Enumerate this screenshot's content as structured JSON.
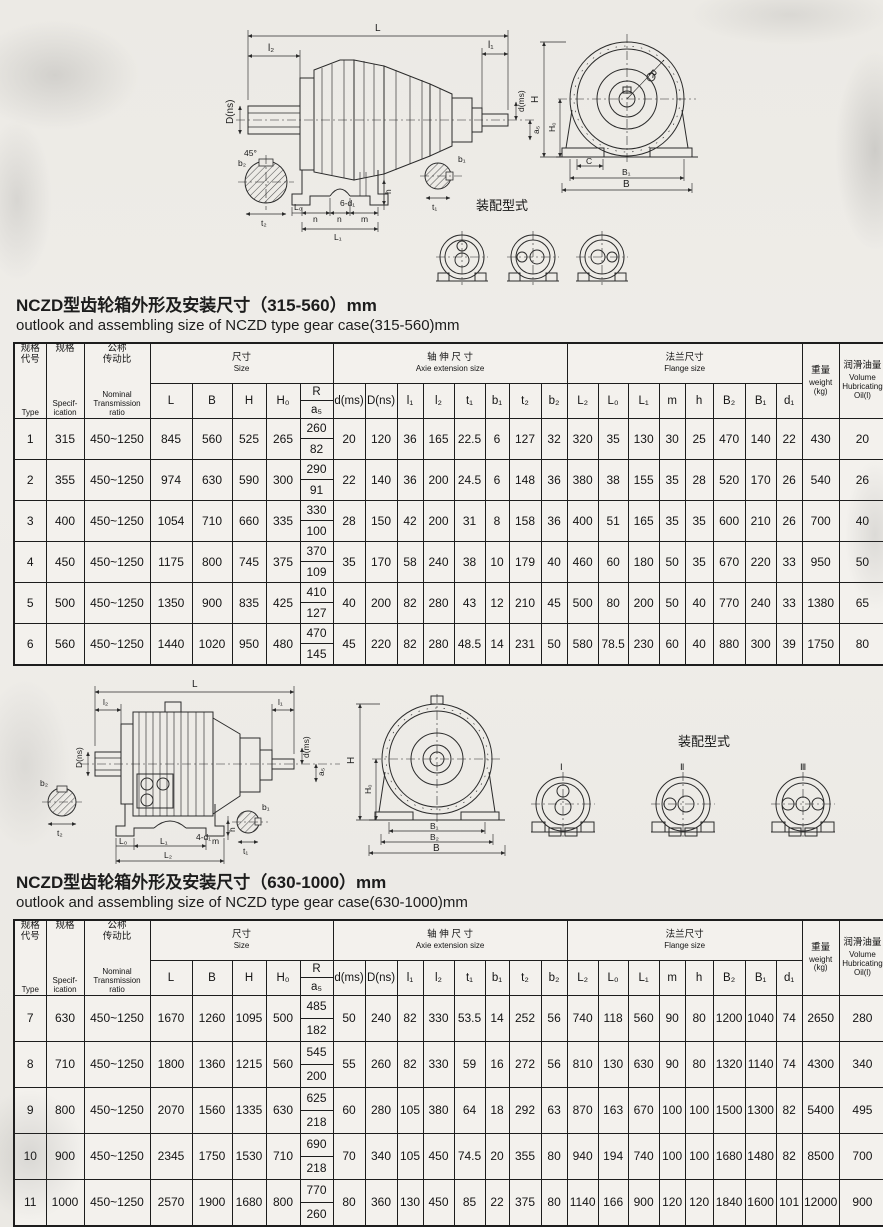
{
  "section1": {
    "title_zh": "NCZD型齿轮箱外形及安装尺寸（315-560）mm",
    "title_en": "outlook and assembling size of NCZD type gear case(315-560)mm"
  },
  "section2": {
    "title_zh": "NCZD型齿轮箱外形及安装尺寸（630-1000）mm",
    "title_en": "outlook and assembling size of NCZD type gear case(630-1000)mm"
  },
  "assembly_label": "装配型式",
  "diagram1": {
    "side_dims": {
      "L": "L",
      "l2": "l₂",
      "l1": "l₁",
      "Dns": "D(ns)",
      "dms": "d(ms)",
      "a5": "a₅",
      "b2": "b₂",
      "t2": "t₂",
      "deg45": "45°",
      "L0": "L₀",
      "n1": "n",
      "holes": "6-d₁",
      "n2": "n",
      "m": "m",
      "L1": "L₁",
      "h": "h",
      "b1": "b₁",
      "t1": "t₁"
    },
    "front_dims": {
      "H": "H",
      "H0": "H₀",
      "R": "R",
      "C": "C",
      "B1": "B₁",
      "B": "B"
    }
  },
  "diagram2": {
    "side_dims": {
      "L": "L",
      "l2": "l₂",
      "l1": "l₁",
      "Dns": "D(ns)",
      "dms": "d(ms)",
      "a5": "a₅",
      "b2": "b₂",
      "t2": "t₂",
      "L0": "L₀",
      "L1": "L₁",
      "holes": "4-d₁",
      "m": "m",
      "L2": "L₂",
      "h": "h",
      "b1": "b₁",
      "t1": "t₁"
    },
    "front_dims": {
      "H": "H",
      "H0": "H₀",
      "B1": "B₁",
      "B2": "B₂",
      "B": "B"
    },
    "variant_labels": [
      "Ⅰ",
      "Ⅱ",
      "Ⅲ"
    ]
  },
  "table_header": {
    "type_zh": "规格\n代号",
    "type_en": "Type",
    "spec_zh": "规格",
    "spec_en": "Specif-\nication",
    "ratio_zh": "公称\n传动比",
    "ratio_en": "Nominal\nTransmission\nratio",
    "size_zh": "尺寸",
    "size_en": "Size",
    "size_cols": [
      "L",
      "B",
      "H",
      "H₀"
    ],
    "r_top": "R",
    "r_bottom": "a₅",
    "axle_zh": "轴 伸 尺 寸",
    "axle_en": "Axie extension size",
    "axle_cols": [
      "d(ms)",
      "D(ns)",
      "l₁",
      "l₂",
      "t₁",
      "b₁",
      "t₂",
      "b₂"
    ],
    "flange_zh": "法兰尺寸",
    "flange_en": "Flange size",
    "flange_cols": [
      "L₂",
      "L₀",
      "L₁",
      "m",
      "h",
      "B₂",
      "B₁",
      "d₁"
    ],
    "weight_zh": "重量",
    "weight_en": "weight\n(kg)",
    "oil_zh": "润滑油量",
    "oil_en": "Volume\nHubricating\nOil(l)"
  },
  "table1": {
    "rows": [
      [
        "1",
        "315",
        "450~1250",
        "845",
        "560",
        "525",
        "265",
        [
          "260",
          "82"
        ],
        "20",
        "120",
        "36",
        "165",
        "22.5",
        "6",
        "127",
        "32",
        "320",
        "35",
        "130",
        "30",
        "25",
        "470",
        "140",
        "22",
        "430",
        "20"
      ],
      [
        "2",
        "355",
        "450~1250",
        "974",
        "630",
        "590",
        "300",
        [
          "290",
          "91"
        ],
        "22",
        "140",
        "36",
        "200",
        "24.5",
        "6",
        "148",
        "36",
        "380",
        "38",
        "155",
        "35",
        "28",
        "520",
        "170",
        "26",
        "540",
        "26"
      ],
      [
        "3",
        "400",
        "450~1250",
        "1054",
        "710",
        "660",
        "335",
        [
          "330",
          "100"
        ],
        "28",
        "150",
        "42",
        "200",
        "31",
        "8",
        "158",
        "36",
        "400",
        "51",
        "165",
        "35",
        "35",
        "600",
        "210",
        "26",
        "700",
        "40"
      ],
      [
        "4",
        "450",
        "450~1250",
        "1175",
        "800",
        "745",
        "375",
        [
          "370",
          "109"
        ],
        "35",
        "170",
        "58",
        "240",
        "38",
        "10",
        "179",
        "40",
        "460",
        "60",
        "180",
        "50",
        "35",
        "670",
        "220",
        "33",
        "950",
        "50"
      ],
      [
        "5",
        "500",
        "450~1250",
        "1350",
        "900",
        "835",
        "425",
        [
          "410",
          "127"
        ],
        "40",
        "200",
        "82",
        "280",
        "43",
        "12",
        "210",
        "45",
        "500",
        "80",
        "200",
        "50",
        "40",
        "770",
        "240",
        "33",
        "1380",
        "65"
      ],
      [
        "6",
        "560",
        "450~1250",
        "1440",
        "1020",
        "950",
        "480",
        [
          "470",
          "145"
        ],
        "45",
        "220",
        "82",
        "280",
        "48.5",
        "14",
        "231",
        "50",
        "580",
        "78.5",
        "230",
        "60",
        "40",
        "880",
        "300",
        "39",
        "1750",
        "80"
      ]
    ]
  },
  "table2": {
    "rows": [
      [
        "7",
        "630",
        "450~1250",
        "1670",
        "1260",
        "1095",
        "500",
        [
          "485",
          "182"
        ],
        "50",
        "240",
        "82",
        "330",
        "53.5",
        "14",
        "252",
        "56",
        "740",
        "118",
        "560",
        "90",
        "80",
        "1200",
        "1040",
        "74",
        "2650",
        "280"
      ],
      [
        "8",
        "710",
        "450~1250",
        "1800",
        "1360",
        "1215",
        "560",
        [
          "545",
          "200"
        ],
        "55",
        "260",
        "82",
        "330",
        "59",
        "16",
        "272",
        "56",
        "810",
        "130",
        "630",
        "90",
        "80",
        "1320",
        "1140",
        "74",
        "4300",
        "340"
      ],
      [
        "9",
        "800",
        "450~1250",
        "2070",
        "1560",
        "1335",
        "630",
        [
          "625",
          "218"
        ],
        "60",
        "280",
        "105",
        "380",
        "64",
        "18",
        "292",
        "63",
        "870",
        "163",
        "670",
        "100",
        "100",
        "1500",
        "1300",
        "82",
        "5400",
        "495"
      ],
      [
        "10",
        "900",
        "450~1250",
        "2345",
        "1750",
        "1530",
        "710",
        [
          "690",
          "218"
        ],
        "70",
        "340",
        "105",
        "450",
        "74.5",
        "20",
        "355",
        "80",
        "940",
        "194",
        "740",
        "100",
        "100",
        "1680",
        "1480",
        "82",
        "8500",
        "700"
      ],
      [
        "11",
        "1000",
        "450~1250",
        "2570",
        "1900",
        "1680",
        "800",
        [
          "770",
          "260"
        ],
        "80",
        "360",
        "130",
        "450",
        "85",
        "22",
        "375",
        "80",
        "1140",
        "166",
        "900",
        "120",
        "120",
        "1840",
        "1600",
        "101",
        "12000",
        "900"
      ]
    ]
  }
}
